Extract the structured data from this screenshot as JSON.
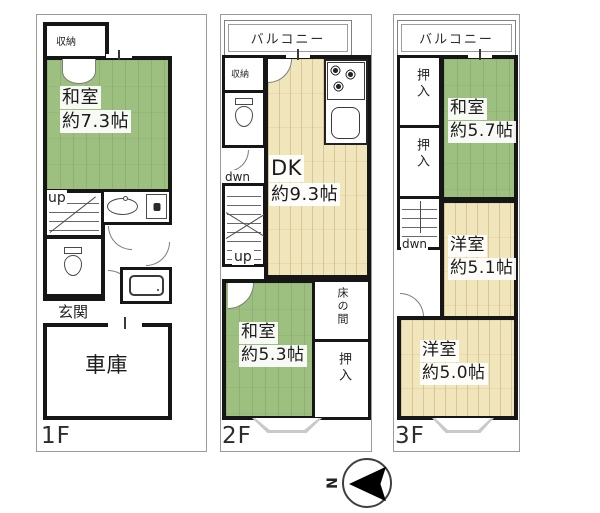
{
  "floors": [
    {
      "label": "1F",
      "closet": "収納",
      "washitsu": "和室",
      "washitsu_size": "約7.3帖",
      "up": "up",
      "genkan": "玄関",
      "garage": "車庫"
    },
    {
      "label": "2F",
      "balcony": "バルコニー",
      "closet": "収納",
      "dwn": "dwn",
      "up": "up",
      "dk": "DK",
      "dk_size": "約9.3帖",
      "washitsu": "和室",
      "washitsu_size": "約5.3帖",
      "tokonoma": "床の間",
      "oshiire": "押入"
    },
    {
      "label": "3F",
      "balcony": "バルコニー",
      "oshiire_upper": "押入",
      "oshiire_lower": "押入",
      "washitsu": "和室",
      "washitsu_size": "約5.7帖",
      "dwn": "dwn",
      "yoshitsu_a": "洋室",
      "yoshitsu_a_size": "約5.1帖",
      "yoshitsu_b": "洋室",
      "yoshitsu_b_size": "約5.0帖"
    }
  ],
  "compass": {
    "north": "N"
  },
  "colors": {
    "tatami_green": "#9dbf7f",
    "wood_beige": "#f1e5bb",
    "wall": "#161616",
    "lot_outline": "#9a9a9a"
  }
}
